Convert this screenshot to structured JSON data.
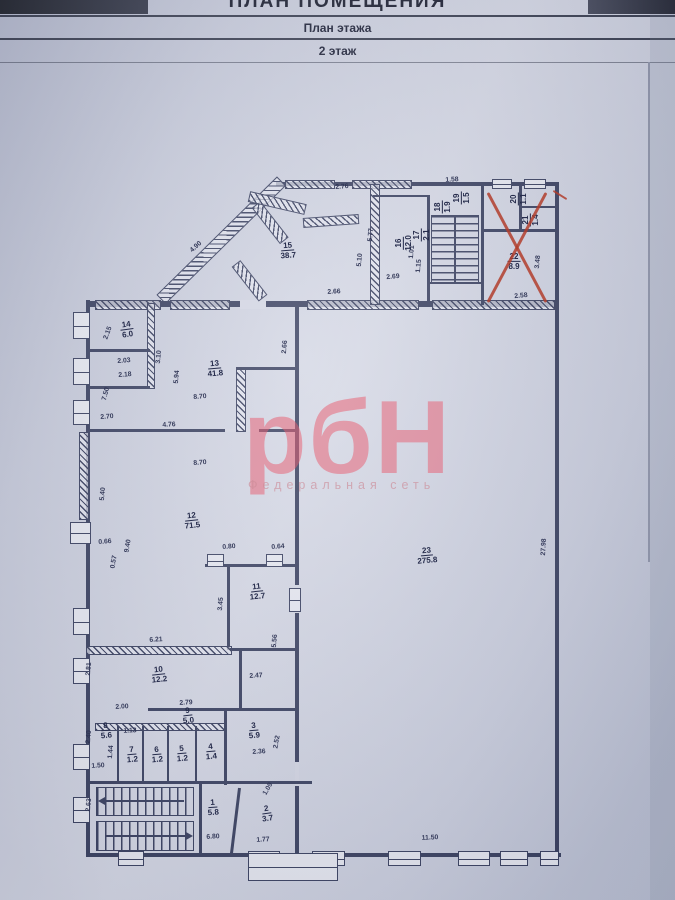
{
  "header": {
    "title": "ПЛАН ПОМЕЩЕНИЯ",
    "subtitle": "План этажа",
    "floor": "2 этаж"
  },
  "watermark": {
    "text": "рбН",
    "subtext": "Федеральная сеть"
  },
  "colors": {
    "wall": "#394060",
    "paper": "#d0d4e2",
    "red_mark": "#b23e2d",
    "watermark_pink": "#e86073"
  },
  "plan": {
    "crossed_out_room": "22",
    "rooms": [
      {
        "num": "15",
        "area": "38.7",
        "x": 288,
        "y": 251,
        "rot": -4
      },
      {
        "num": "16",
        "area": "12.0",
        "x": 404,
        "y": 243,
        "rot": -90
      },
      {
        "num": "17",
        "area": "2.1",
        "x": 422,
        "y": 235,
        "rot": -90
      },
      {
        "num": "18",
        "area": "1.9",
        "x": 443,
        "y": 207,
        "rot": -90
      },
      {
        "num": "19",
        "area": "1.5",
        "x": 462,
        "y": 198,
        "rot": -90
      },
      {
        "num": "20",
        "area": "1.1",
        "x": 519,
        "y": 199,
        "rot": -90
      },
      {
        "num": "21",
        "area": "1.4",
        "x": 531,
        "y": 220,
        "rot": -90
      },
      {
        "num": "22",
        "area": "8.9",
        "x": 514,
        "y": 262,
        "rot": 0
      },
      {
        "num": "14",
        "area": "6.0",
        "x": 127,
        "y": 330,
        "rot": -8
      },
      {
        "num": "13",
        "area": "41.8",
        "x": 215,
        "y": 369,
        "rot": -5
      },
      {
        "num": "12",
        "area": "71.5",
        "x": 192,
        "y": 521,
        "rot": -6
      },
      {
        "num": "23",
        "area": "275.8",
        "x": 427,
        "y": 556,
        "rot": -5
      },
      {
        "num": "11",
        "area": "12.7",
        "x": 257,
        "y": 592,
        "rot": -6
      },
      {
        "num": "10",
        "area": "12.2",
        "x": 159,
        "y": 675,
        "rot": -6
      },
      {
        "num": "9",
        "area": "5.0",
        "x": 188,
        "y": 716,
        "rot": -6
      },
      {
        "num": "8",
        "area": "5.6",
        "x": 106,
        "y": 731,
        "rot": -5
      },
      {
        "num": "7",
        "area": "1.2",
        "x": 132,
        "y": 755,
        "rot": -5
      },
      {
        "num": "6",
        "area": "1.2",
        "x": 157,
        "y": 755,
        "rot": -5
      },
      {
        "num": "5",
        "area": "1.2",
        "x": 182,
        "y": 754,
        "rot": -5
      },
      {
        "num": "4",
        "area": "1.4",
        "x": 211,
        "y": 752,
        "rot": -5
      },
      {
        "num": "3",
        "area": "5.9",
        "x": 254,
        "y": 731,
        "rot": -5
      },
      {
        "num": "1",
        "area": "5.8",
        "x": 213,
        "y": 808,
        "rot": -4
      },
      {
        "num": "2",
        "area": "3.7",
        "x": 267,
        "y": 814,
        "rot": -8
      }
    ],
    "dims": [
      {
        "t": "2.76",
        "x": 342,
        "y": 187,
        "r": -4
      },
      {
        "t": "1.58",
        "x": 452,
        "y": 180,
        "r": -3
      },
      {
        "t": "4.90",
        "x": 196,
        "y": 247,
        "r": -42
      },
      {
        "t": "5.77",
        "x": 371,
        "y": 235,
        "r": -85
      },
      {
        "t": "5.10",
        "x": 360,
        "y": 260,
        "r": -85
      },
      {
        "t": "2.66",
        "x": 334,
        "y": 292,
        "r": -3
      },
      {
        "t": "2.69",
        "x": 393,
        "y": 277,
        "r": -5
      },
      {
        "t": "1.01",
        "x": 412,
        "y": 252,
        "r": -85
      },
      {
        "t": "1.15",
        "x": 419,
        "y": 266,
        "r": -85
      },
      {
        "t": "2.58",
        "x": 521,
        "y": 296,
        "r": -5
      },
      {
        "t": "3.48",
        "x": 538,
        "y": 262,
        "r": -85
      },
      {
        "t": "2.15",
        "x": 108,
        "y": 333,
        "r": -70
      },
      {
        "t": "2.03",
        "x": 124,
        "y": 361,
        "r": -4
      },
      {
        "t": "2.18",
        "x": 125,
        "y": 375,
        "r": -4
      },
      {
        "t": "3.10",
        "x": 159,
        "y": 357,
        "r": -85
      },
      {
        "t": "5.94",
        "x": 177,
        "y": 377,
        "r": -85
      },
      {
        "t": "8.70",
        "x": 200,
        "y": 397,
        "r": -4
      },
      {
        "t": "2.66",
        "x": 285,
        "y": 347,
        "r": -85
      },
      {
        "t": "2.70",
        "x": 107,
        "y": 417,
        "r": -4
      },
      {
        "t": "7.50",
        "x": 106,
        "y": 394,
        "r": -75
      },
      {
        "t": "4.76",
        "x": 169,
        "y": 425,
        "r": -3
      },
      {
        "t": "8.70",
        "x": 200,
        "y": 463,
        "r": -4
      },
      {
        "t": "5.40",
        "x": 103,
        "y": 494,
        "r": -85
      },
      {
        "t": "0.66",
        "x": 105,
        "y": 542,
        "r": -4
      },
      {
        "t": "9.40",
        "x": 128,
        "y": 546,
        "r": -80
      },
      {
        "t": "0.57",
        "x": 114,
        "y": 562,
        "r": -80
      },
      {
        "t": "0.80",
        "x": 229,
        "y": 547,
        "r": -4
      },
      {
        "t": "0.64",
        "x": 278,
        "y": 547,
        "r": -4
      },
      {
        "t": "27.98",
        "x": 544,
        "y": 547,
        "r": -87
      },
      {
        "t": "3.45",
        "x": 221,
        "y": 604,
        "r": -85
      },
      {
        "t": "6.21",
        "x": 156,
        "y": 640,
        "r": -3
      },
      {
        "t": "5.56",
        "x": 275,
        "y": 641,
        "r": -85
      },
      {
        "t": "2.81",
        "x": 89,
        "y": 669,
        "r": -85
      },
      {
        "t": "2.47",
        "x": 256,
        "y": 676,
        "r": -3
      },
      {
        "t": "2.00",
        "x": 122,
        "y": 707,
        "r": -3
      },
      {
        "t": "2.79",
        "x": 186,
        "y": 703,
        "r": -3
      },
      {
        "t": "1.13",
        "x": 130,
        "y": 731,
        "r": -3
      },
      {
        "t": "2.40",
        "x": 89,
        "y": 737,
        "r": -85
      },
      {
        "t": "1.44",
        "x": 111,
        "y": 752,
        "r": -85
      },
      {
        "t": "1.50",
        "x": 98,
        "y": 766,
        "r": -3
      },
      {
        "t": "2.36",
        "x": 259,
        "y": 752,
        "r": -3
      },
      {
        "t": "2.52",
        "x": 277,
        "y": 742,
        "r": -80
      },
      {
        "t": "1.09",
        "x": 268,
        "y": 789,
        "r": -60
      },
      {
        "t": "2.63",
        "x": 89,
        "y": 805,
        "r": -85
      },
      {
        "t": "6.80",
        "x": 213,
        "y": 837,
        "r": -3
      },
      {
        "t": "1.77",
        "x": 263,
        "y": 840,
        "r": -3
      },
      {
        "t": "11.50",
        "x": 430,
        "y": 838,
        "r": -3
      }
    ]
  }
}
